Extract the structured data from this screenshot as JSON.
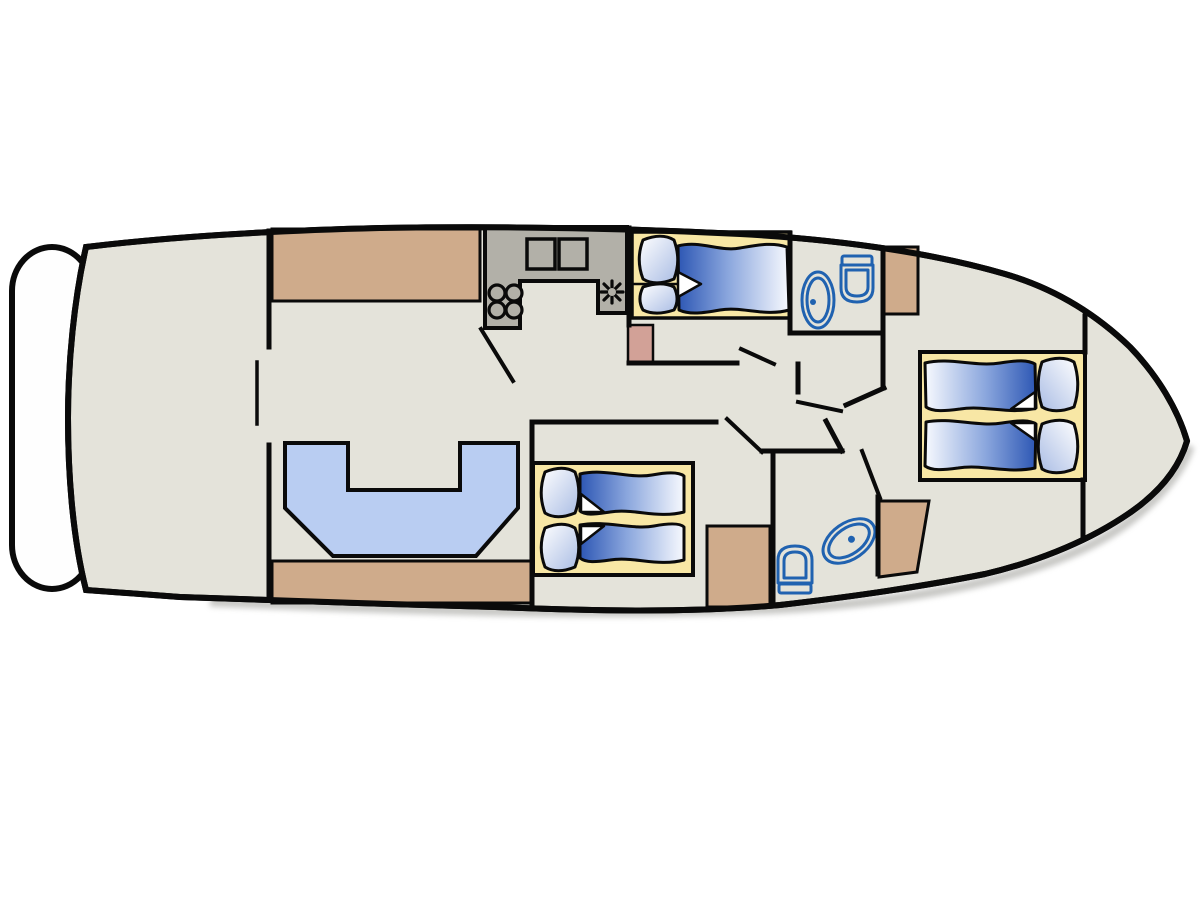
{
  "page": {
    "kind": "yacht-interior-deck-floor-plan",
    "orientation": "bow-right-stern-left"
  },
  "colors": {
    "background": "#ffffff",
    "line": "#0a0a0a",
    "shadow": "#8f8f89",
    "deckFloor": "#e4e3da",
    "platformWhite": "#fefefe",
    "counterGray": "#b2b0a8",
    "woodTan": "#cfab8b",
    "woodPink": "#d2a197",
    "bedBaseYellow": "#f8e7a5",
    "sofaBlue": "#b9cdf2",
    "bedDarkBlue": "#2d57b4",
    "bedMidBlue": "#8aa6dd",
    "bedLightBlue": "#f7f9fe",
    "pillowBlue": "#a9bce4",
    "pillowWhite": "#ffffff",
    "foldWhite": "#ffffff",
    "fixtureBlue": "#2062b0"
  },
  "legend": {
    "rooms": [
      {
        "name": "swim-platform"
      },
      {
        "name": "aft-cockpit"
      },
      {
        "name": "salon-with-u-sofa"
      },
      {
        "name": "galley"
      },
      {
        "name": "mid-cabin-double-bed"
      },
      {
        "name": "head-forward-starboard"
      },
      {
        "name": "mid-cabin-twin-beds"
      },
      {
        "name": "head-aft-port"
      },
      {
        "name": "bow-cabin-twin-beds"
      }
    ],
    "fixtures": [
      "u-shaped-sofa",
      "galley-counter",
      "double-sink",
      "four-burner-stove",
      "vent-fan",
      "toilet",
      "washbasin",
      "wardrobe",
      "bed-with-pillows-and-duvet"
    ]
  }
}
